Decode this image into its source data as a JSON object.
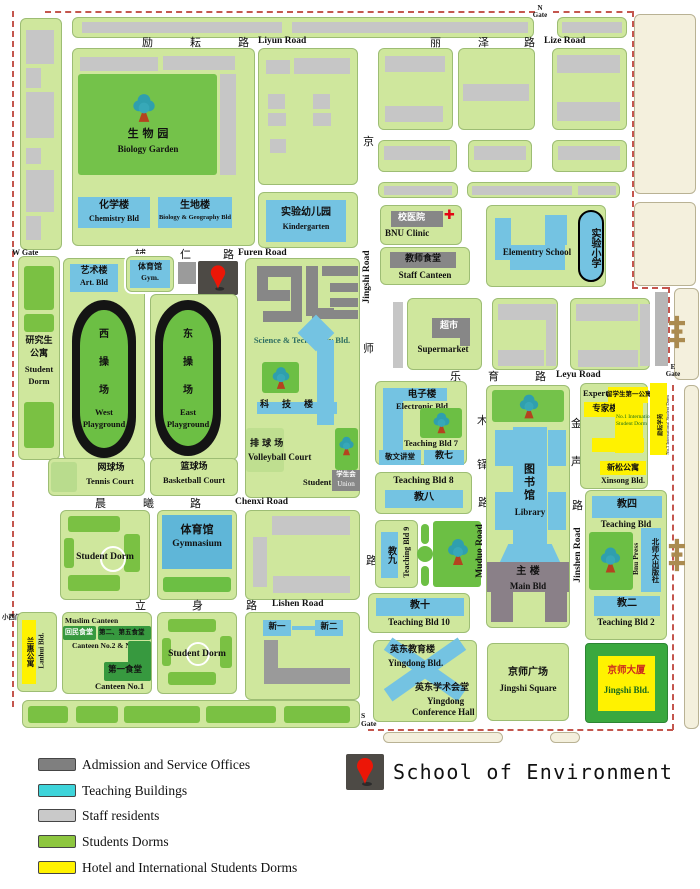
{
  "title": {
    "text": "School of Environment"
  },
  "icons": {
    "red_cross": "✚"
  },
  "legend": {
    "items": [
      {
        "label": "Admission and Service Offices",
        "color": "#7f7f7f"
      },
      {
        "label": "Teaching Buildings",
        "color": "#3ed4da"
      },
      {
        "label": "Staff residents",
        "color": "#c9c9c9"
      },
      {
        "label": "Students Dorms",
        "color": "#8dc63f"
      },
      {
        "label": "Hotel and International Students Dorms",
        "color": "#fff200"
      }
    ]
  },
  "gates": {
    "north": {
      "l1": "N",
      "l2": "Gate"
    },
    "south": {
      "l1": "S",
      "l2": "Gate"
    },
    "east": {
      "l1": "E",
      "l2": "Gate"
    },
    "west": {
      "label": "W Gate"
    },
    "small_west": {
      "zh": "小西门",
      "en": "West Gate"
    }
  },
  "roads": {
    "liyun": {
      "c1": "励",
      "c2": "耘",
      "c3": "路",
      "en": "Liyun Road"
    },
    "lize": {
      "c1": "丽",
      "c2": "泽",
      "c3": "路",
      "en": "Lize Road"
    },
    "furen": {
      "c1": "辅",
      "c2": "仁",
      "c3": "路",
      "en": "Furen Road"
    },
    "chenxi": {
      "c1": "晨",
      "c2": "曦",
      "c3": "路",
      "en": "Chenxi Road"
    },
    "lishen": {
      "c1": "立",
      "c2": "身",
      "c3": "路",
      "en": "Lishen Road"
    },
    "leyu": {
      "c1": "乐",
      "c2": "育",
      "c3": "路",
      "en": "Leyu Road"
    },
    "jingshi": {
      "c1": "京",
      "c2": "师",
      "c3": "路",
      "en": "Jingshi Road"
    },
    "muduo": {
      "c1": "木",
      "c2": "铎",
      "c3": "路",
      "en": "Muduo Road"
    },
    "jinshen": {
      "c1": "金",
      "c2": "声",
      "c3": "路",
      "en": "Jinshen Road"
    }
  },
  "bld": {
    "biology_garden": {
      "zh": "生 物 园",
      "en": "Biology Garden"
    },
    "chemistry": {
      "zh": "化学楼",
      "en": "Chemistry Bld"
    },
    "bio_geo": {
      "zh": "生地楼",
      "en": "Biology & Geography Bld"
    },
    "kindergarten": {
      "zh": "实验幼儿园",
      "en": "Kindergarten"
    },
    "clinic": {
      "zh": "校医院",
      "en": "BNU Clinic"
    },
    "staff_canteen": {
      "zh": "教师食堂",
      "en": "Staff Canteen"
    },
    "elementary": {
      "en": "Elementry School"
    },
    "exp_primary": {
      "zh": "实验小学"
    },
    "art": {
      "zh": "艺术楼",
      "en": "Art. Bld"
    },
    "gym_small": {
      "zh": "体育馆",
      "en": "Gym."
    },
    "grad_dorm": {
      "zh1": "研究生",
      "zh2": "公寓",
      "en1": "Student",
      "en2": "Dorm"
    },
    "west_pg": {
      "c1": "西",
      "c2": "操",
      "c3": "场",
      "en1": "West",
      "en2": "Playground"
    },
    "east_pg": {
      "c1": "东",
      "c2": "操",
      "c3": "场",
      "en1": "East",
      "en2": "Playground"
    },
    "tennis": {
      "zh": "网球场",
      "en": "Tennis Court"
    },
    "basketball": {
      "zh": "篮球场",
      "en": "Basketball Court"
    },
    "scitech": {
      "en": "Science & Technology Bld."
    },
    "keji": {
      "c1": "科",
      "c2": "技",
      "c3": "楼"
    },
    "volleyball": {
      "zh": "排 球 场",
      "en": "Volleyball Court"
    },
    "union": {
      "zh": "学生会",
      "en1": "Student",
      "en2": "Union"
    },
    "supermarket": {
      "zh": "超市",
      "en": "Supermarket"
    },
    "electronic": {
      "zh": "电子楼",
      "en": "Electronic Bld"
    },
    "t7": {
      "en": "Teaching Bld 7"
    },
    "jingwen": {
      "zh": "敬文讲堂"
    },
    "t7b": {
      "zh": "教七"
    },
    "t8": {
      "en": "Teaching Bld 8",
      "zh": "教八"
    },
    "t9": {
      "en": "Teaching Bld 9",
      "zh": "教九"
    },
    "t10": {
      "en": "Teaching Bld 10",
      "zh": "教十"
    },
    "library": {
      "zh": "图书馆",
      "en": "Library"
    },
    "main": {
      "zh": "主  楼",
      "en": "Main Bld"
    },
    "expert": {
      "en": "Expert Bld",
      "zh": "专家楼"
    },
    "intl1": {
      "zh": "留学生第一公寓",
      "en": "No.1 International Student Dorm"
    },
    "intl3": {
      "zh": "励耘学苑",
      "en": "No.3 International Student Dorm"
    },
    "xinsong": {
      "zh": "新松公寓",
      "en": "Xinsong Bld."
    },
    "t4": {
      "zh": "教四",
      "en": "Teaching Bld"
    },
    "press": {
      "zh": "北师大出版社",
      "en": "Bnu Press"
    },
    "t2": {
      "zh": "教二",
      "en": "Teaching Bld 2"
    },
    "gymnasium": {
      "zh": "体育馆",
      "en": "Gymnasium"
    },
    "dorm1": {
      "en": "Student Dorm"
    },
    "dorm2": {
      "en": "Student Dorm"
    },
    "lanhui": {
      "zh": "兰惠公寓",
      "en": "Lanhui Bld."
    },
    "muslim": {
      "en": "Muslim Canteen",
      "zh": "回民食堂"
    },
    "canteen25": {
      "zh": "第二、第五食堂",
      "en": "Canteen No.2 & No.5"
    },
    "canteen1": {
      "zh": "第一食堂",
      "en": "Canteen No.1"
    },
    "xinyi": {
      "zh": "新一"
    },
    "xiner": {
      "zh": "新二"
    },
    "yingdong": {
      "zh": "英东教育楼",
      "en": "Yingdong Bld."
    },
    "ydhall": {
      "zh": "英东学术会堂",
      "en1": "Yingdong",
      "en2": "Conference Hall"
    },
    "jssquare": {
      "zh": "京师广场",
      "en": "Jingshi Square"
    },
    "jsbld": {
      "zh": "京师大厦",
      "en": "Jingshi Bld."
    }
  }
}
